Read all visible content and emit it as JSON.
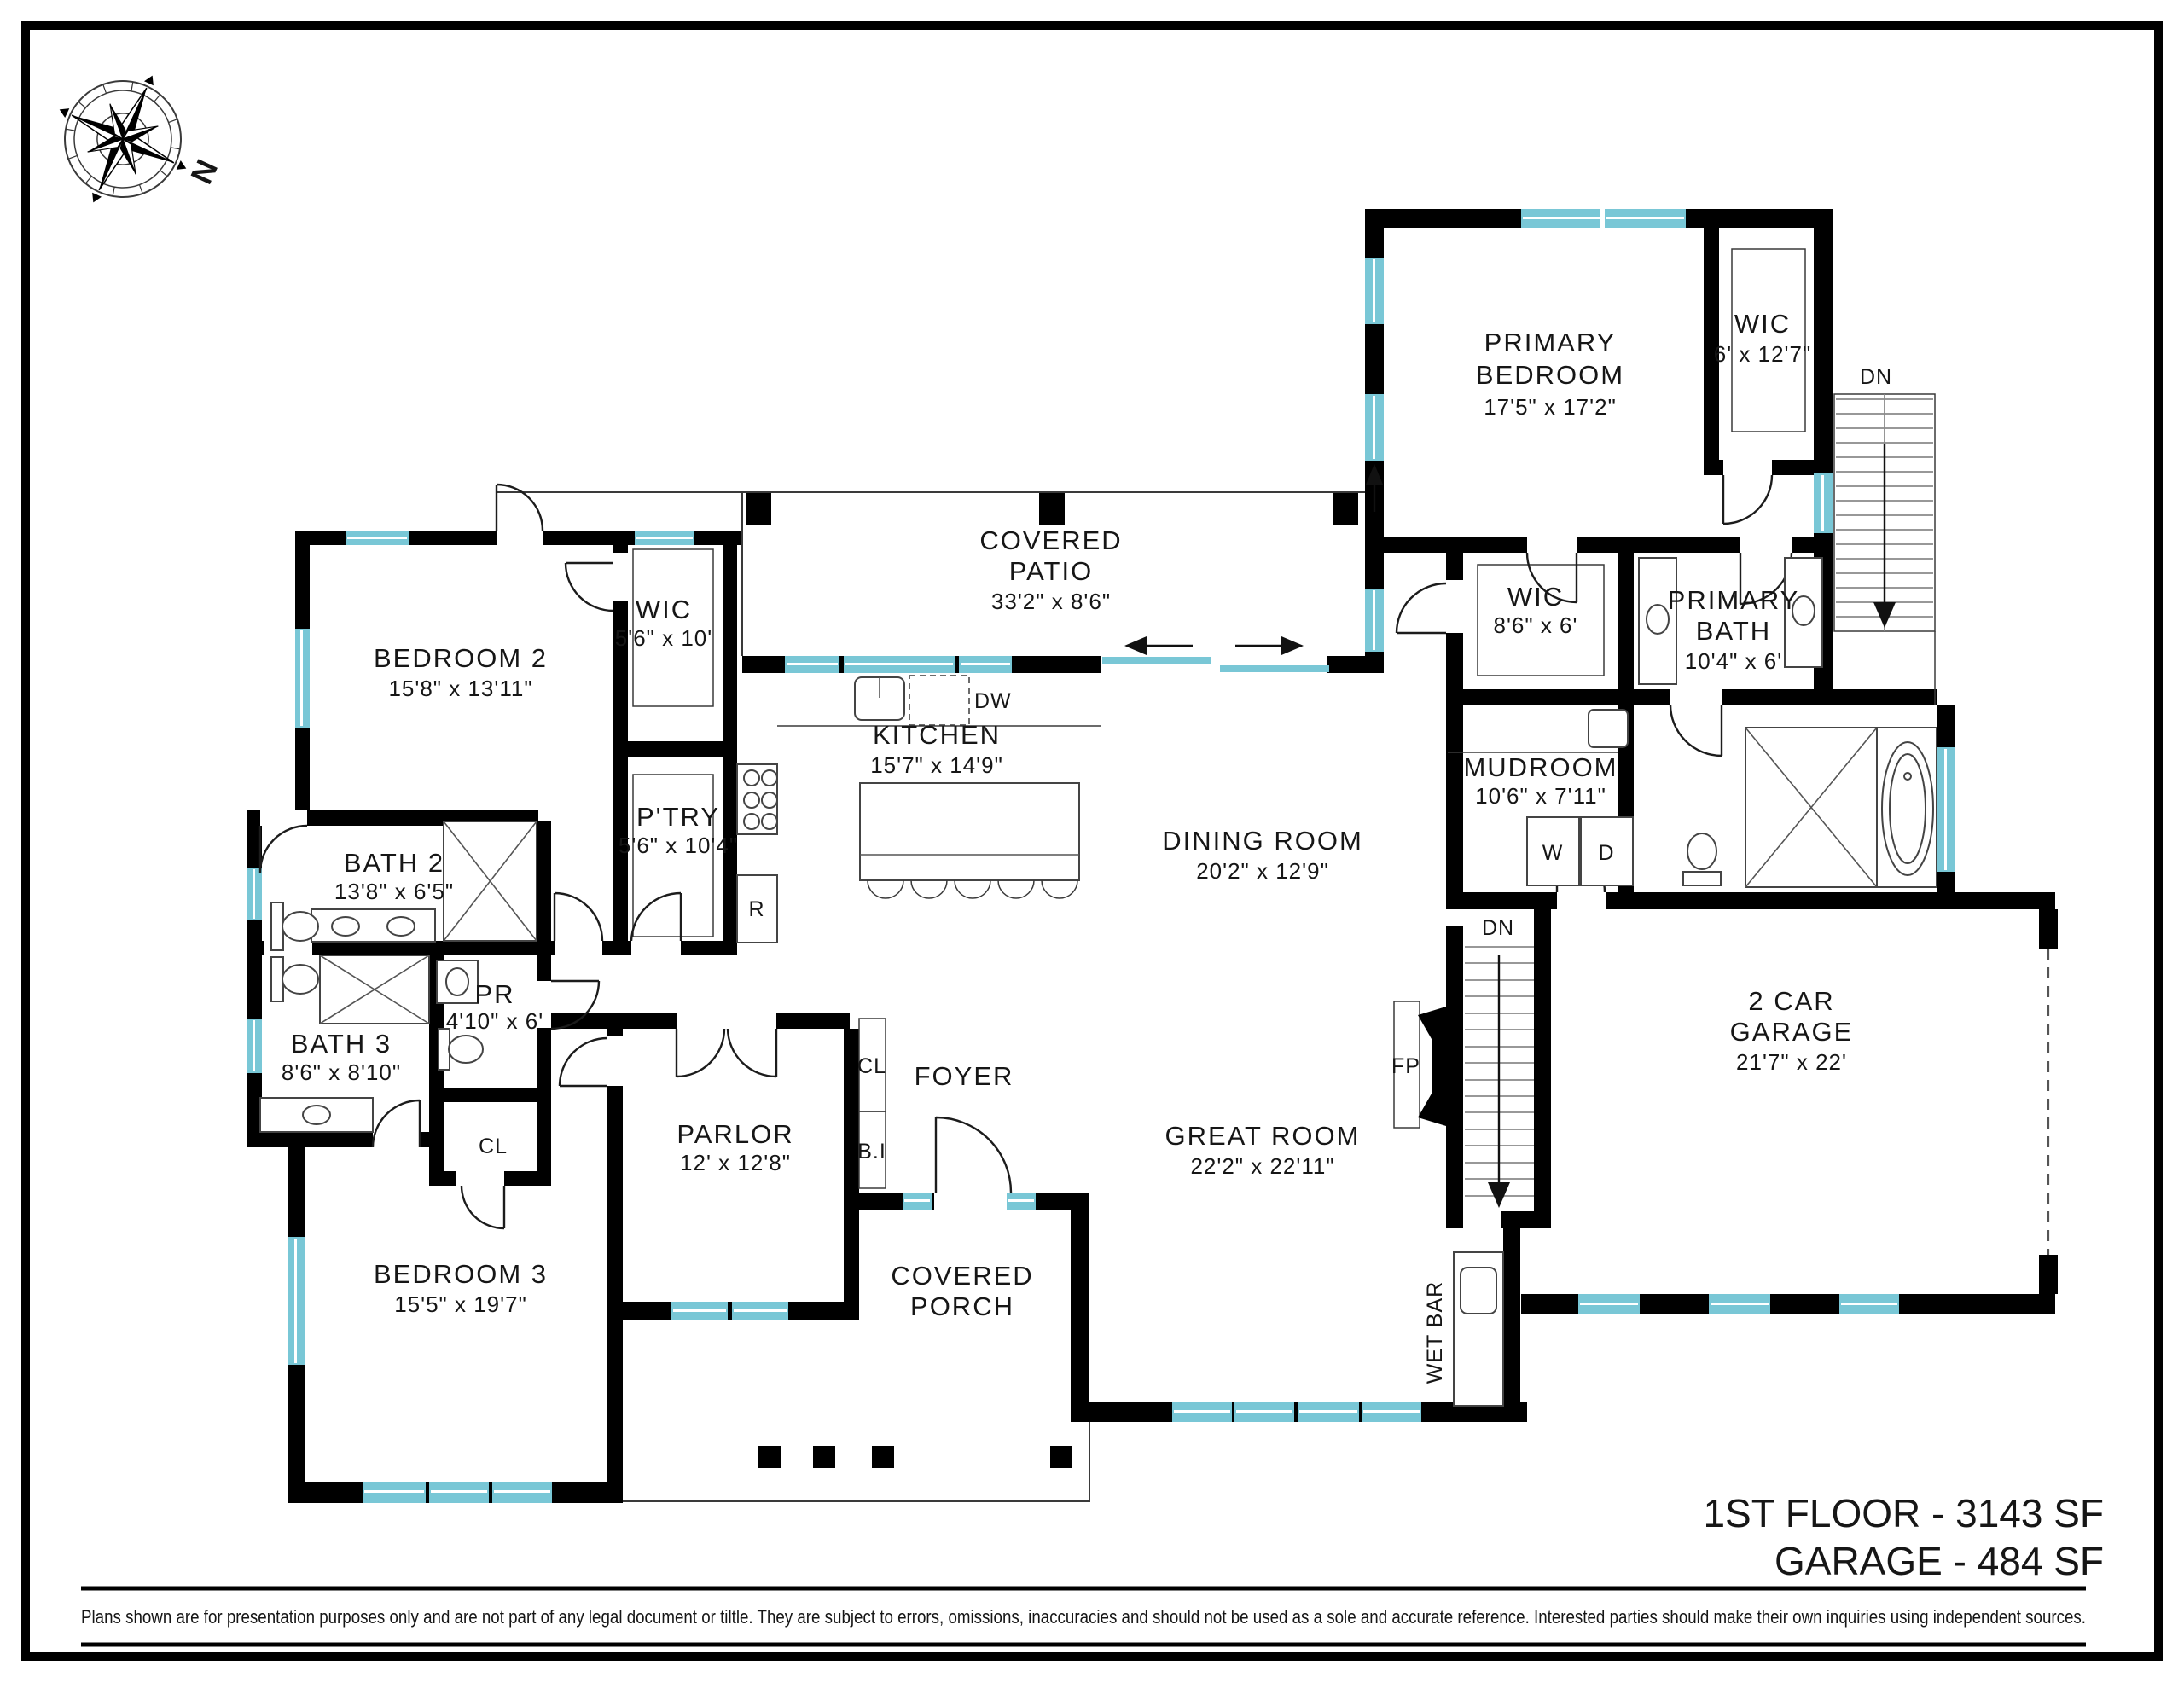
{
  "compass": {
    "north_label": "N"
  },
  "rooms": {
    "primary_bedroom": {
      "line1": "PRIMARY",
      "line2": "BEDROOM",
      "dims": "17'5\" x 17'2\""
    },
    "wic_primary": {
      "line1": "WIC",
      "dims": "6' x 12'7\""
    },
    "bedroom2": {
      "line1": "BEDROOM 2",
      "dims": "15'8\" x 13'11\""
    },
    "wic2": {
      "line1": "WIC",
      "dims": "5'6\" x 10'"
    },
    "covered_patio": {
      "line1": "COVERED",
      "line2": "PATIO",
      "dims": "33'2\" x 8'6\""
    },
    "kitchen": {
      "line1": "KITCHEN",
      "dims": "15'7\" x 14'9\""
    },
    "pantry": {
      "line1": "P'TRY",
      "dims": "5'6\" x 10'4\""
    },
    "bath2": {
      "line1": "BATH 2",
      "dims": "13'8\" x 6'5\""
    },
    "powder": {
      "line1": "PR",
      "dims": "4'10\" x 6'"
    },
    "bath3": {
      "line1": "BATH 3",
      "dims": "8'6\" x 8'10\""
    },
    "bedroom3": {
      "line1": "BEDROOM 3",
      "dims": "15'5\" x 19'7\""
    },
    "parlor": {
      "line1": "PARLOR",
      "dims": "12' x 12'8\""
    },
    "foyer": {
      "line1": "FOYER"
    },
    "covered_porch": {
      "line1": "COVERED",
      "line2": "PORCH"
    },
    "great_room": {
      "line1": "GREAT ROOM",
      "dims": "22'2\" x 22'11\""
    },
    "dining_room": {
      "line1": "DINING ROOM",
      "dims": "20'2\" x 12'9\""
    },
    "mudroom": {
      "line1": "MUDROOM",
      "dims": "10'6\" x 7'11\""
    },
    "wic_hall": {
      "line1": "WIC",
      "dims": "8'6\" x 6'"
    },
    "primary_bath": {
      "line1": "PRIMARY",
      "line2": "BATH",
      "dims": "10'4\" x 6'"
    },
    "garage": {
      "line1": "2 CAR",
      "line2": "GARAGE",
      "dims": "21'7\" x 22'"
    }
  },
  "markers": {
    "dn_upper": "DN",
    "dn_lower": "DN",
    "fp": "FP",
    "wet_bar": "WET BAR",
    "dw": "DW",
    "range_fridge": "R",
    "cl_hall": "CL",
    "cl_foyer": "CL",
    "built_in": "B.I",
    "washer": "W",
    "dryer": "D"
  },
  "footer": {
    "area_line1": "1ST FLOOR - 3143 SF",
    "area_line2": "GARAGE - 484 SF",
    "disclaimer": "Plans shown are for presentation purposes only and are not part of any legal document or tiltle. They are subject to errors, omissions, inaccuracies and should not be used as a sole and accurate reference. Interested parties should make their own inquiries using independent sources."
  },
  "colors": {
    "wall": "#000000",
    "window": "#79c7d6",
    "window_light": "#a9dbe4",
    "text": "#161616"
  }
}
